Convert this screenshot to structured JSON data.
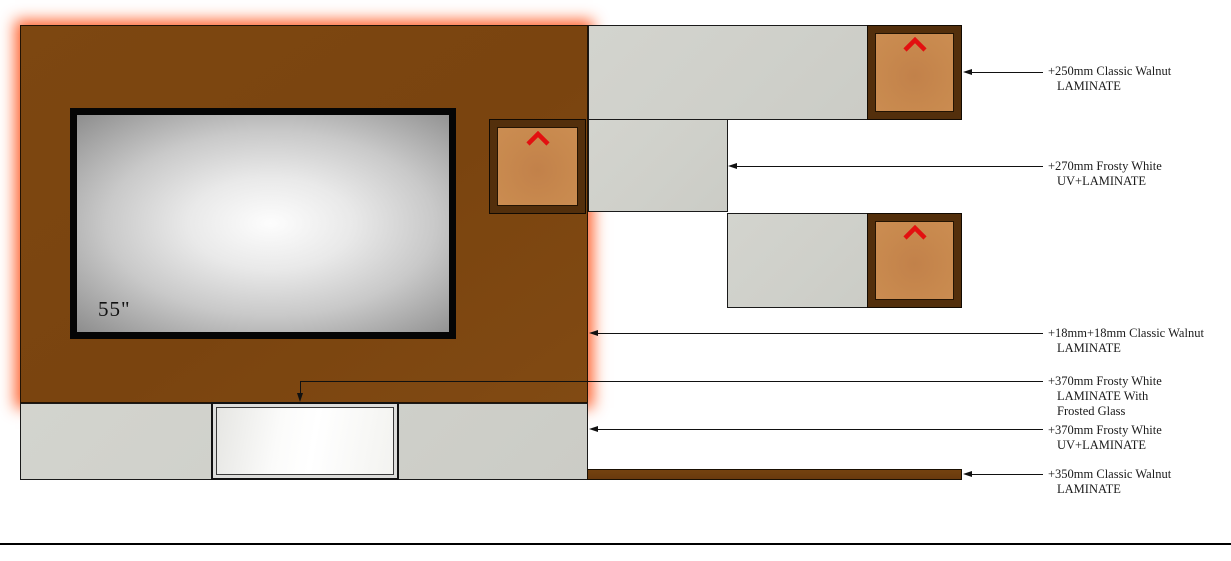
{
  "drawing": {
    "type": "tv-unit-elevation",
    "tv": {
      "size_label": "55\""
    },
    "annotations": [
      {
        "lines": [
          "+250mm Classic Walnut",
          "LAMINATE"
        ]
      },
      {
        "lines": [
          "+270mm Frosty White",
          "UV+LAMINATE"
        ]
      },
      {
        "lines": [
          "+18mm+18mm Classic Walnut",
          "LAMINATE"
        ]
      },
      {
        "lines": [
          "+370mm Frosty White",
          "LAMINATE With",
          "Frosted Glass"
        ]
      },
      {
        "lines": [
          "+370mm Frosty White",
          "UV+LAMINATE"
        ]
      },
      {
        "lines": [
          "+350mm Classic Walnut",
          "LAMINATE"
        ]
      }
    ],
    "icons": [
      {
        "name": "upward-chevron-icon",
        "meaning": "door opens upward",
        "color": "#e31010"
      }
    ],
    "colors": {
      "walnut_panel": "#7d4711",
      "walnut_dark_frame": "#532f0c",
      "walnut_face": "#c8894e",
      "walnut_shelf": "#6b3c10",
      "frosty_white_panel": "#cfd0ca",
      "led_glow": "#ff480a",
      "tv_bezel": "#050505",
      "line_color": "#111111"
    }
  }
}
